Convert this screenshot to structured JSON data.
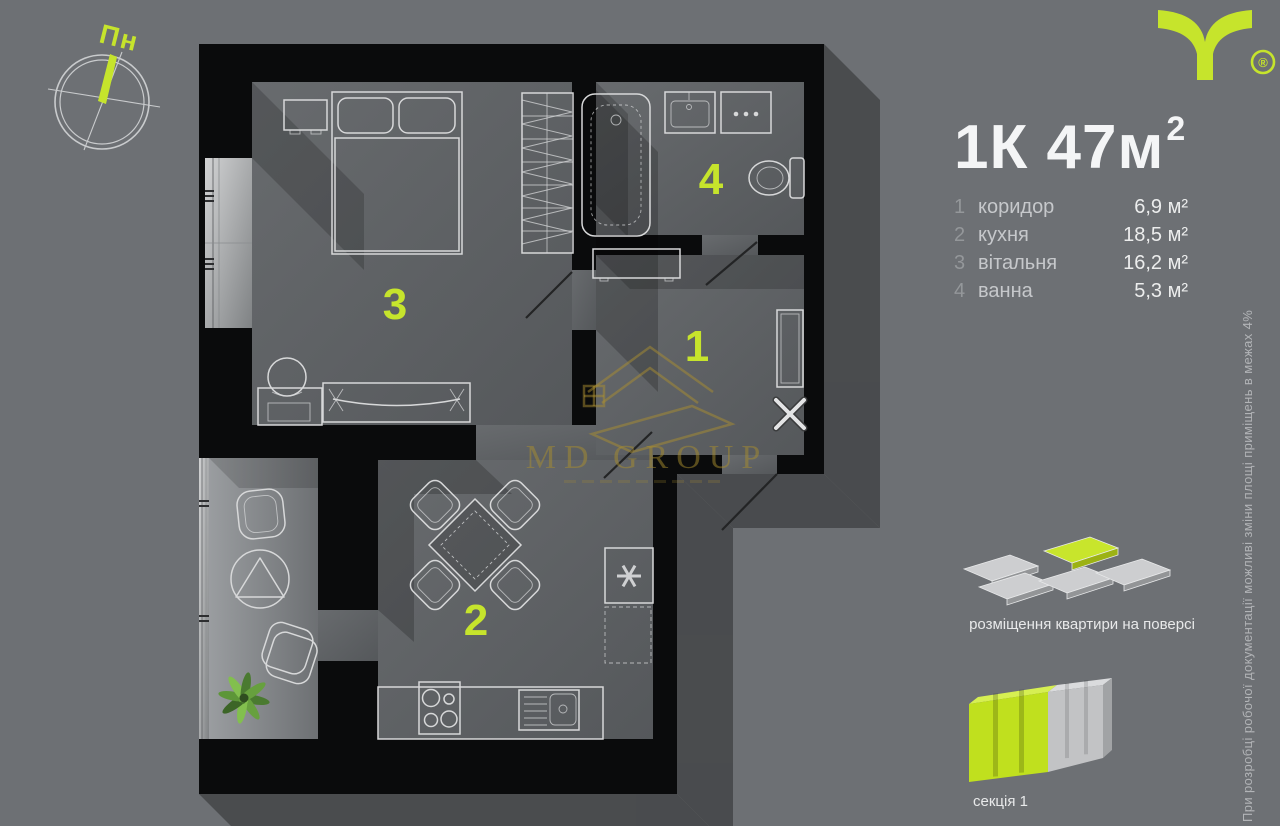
{
  "header": {
    "logo_registered": "®"
  },
  "compass": {
    "label": "Пн"
  },
  "title": {
    "full": "1К 47м²",
    "main": "1К 47м",
    "sup": "2"
  },
  "legend": {
    "items": [
      {
        "num": "1",
        "name": "коридор",
        "area": "6,9 м²"
      },
      {
        "num": "2",
        "name": "кухня",
        "area": "18,5 м²"
      },
      {
        "num": "3",
        "name": "вітальня",
        "area": "16,2 м²"
      },
      {
        "num": "4",
        "name": "ванна",
        "area": "5,3 м²"
      }
    ]
  },
  "plan": {
    "room_numbers": [
      {
        "number": "1"
      },
      {
        "number": "2"
      },
      {
        "number": "3"
      },
      {
        "number": "4"
      }
    ],
    "watermark": "MD GROUP"
  },
  "floor_diagram": {
    "caption": "розміщення квартири на поверсі"
  },
  "section_diagram": {
    "caption": "секція 1"
  },
  "disclaimer": {
    "text": "При розробці робочої документації можливі зміни площі приміщень в межах 4%"
  },
  "colors": {
    "lime": "#c6e42c",
    "background": "#6d7074",
    "wall": "#0a0b0c",
    "gold": "#a98e2f"
  }
}
